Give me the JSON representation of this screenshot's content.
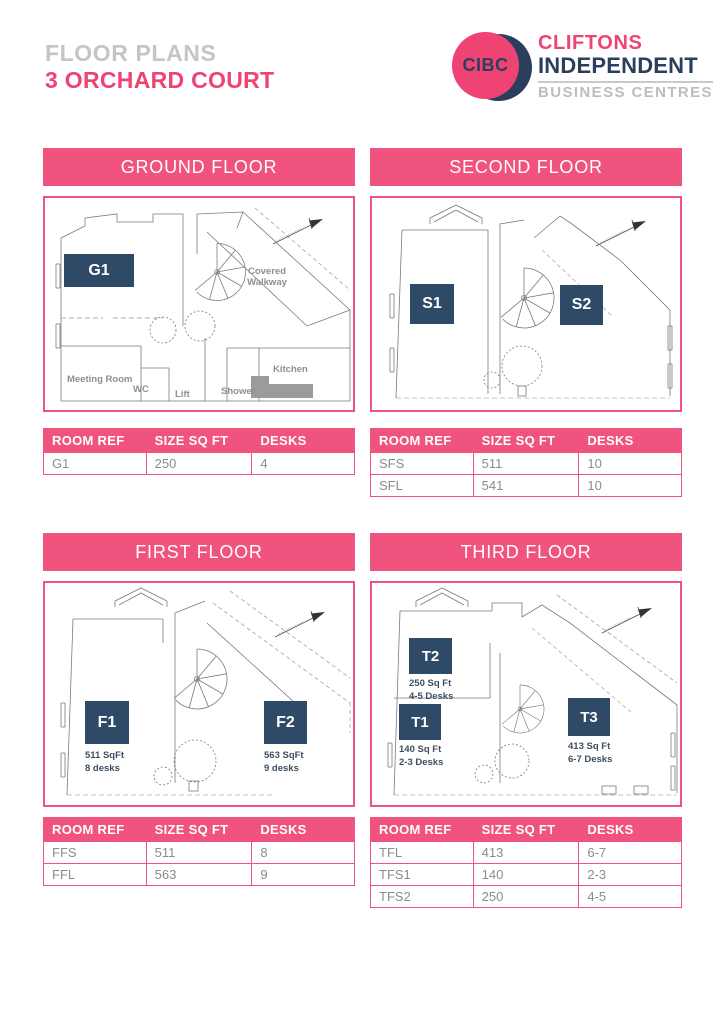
{
  "header": {
    "subtitle": "FLOOR PLANS",
    "title": "3 ORCHARD COURT"
  },
  "logo": {
    "badge_text": "CIBC",
    "name_top": "CLIFTONS",
    "name_bottom": "INDEPENDENT",
    "tagline": "BUSINESS CENTRES"
  },
  "colors": {
    "pink": "#F0537D",
    "title_pink": "#EE4373",
    "navy_room_box": "#2E4A66",
    "logo_navy": "#2B3F5C",
    "subtitle_gray": "#C5C5C5",
    "table_text_gray": "#8C8C8C",
    "plan_line_gray": "#7A7A7A"
  },
  "table_headers": [
    "ROOM REF",
    "SIZE SQ FT",
    "DESKS"
  ],
  "sections": {
    "ground": {
      "title": "GROUND FLOOR",
      "rooms": [
        {
          "id": "G1"
        }
      ],
      "labels": {
        "covered_walkway": "Covered Walkway",
        "meeting_room": "Meeting Room",
        "wc": "WC",
        "lift": "Lift",
        "shower": "Shower",
        "kitchen": "Kitchen"
      },
      "table": [
        [
          "G1",
          "250",
          "4"
        ]
      ]
    },
    "second": {
      "title": "SECOND FLOOR",
      "rooms": [
        {
          "id": "S1"
        },
        {
          "id": "S2"
        }
      ],
      "table": [
        [
          "SFS",
          "511",
          "10"
        ],
        [
          "SFL",
          "541",
          "10"
        ]
      ]
    },
    "first": {
      "title": "FIRST FLOOR",
      "rooms": [
        {
          "id": "F1",
          "size": "511 SqFt",
          "desks": "8 desks"
        },
        {
          "id": "F2",
          "size": "563 SqFt",
          "desks": "9 desks"
        }
      ],
      "table": [
        [
          "FFS",
          "511",
          "8"
        ],
        [
          "FFL",
          "563",
          "9"
        ]
      ]
    },
    "third": {
      "title": "THIRD FLOOR",
      "rooms": [
        {
          "id": "T1",
          "size": "140 Sq Ft",
          "desks": "2-3 Desks"
        },
        {
          "id": "T2",
          "size": "250 Sq Ft",
          "desks": "4-5 Desks"
        },
        {
          "id": "T3",
          "size": "413 Sq Ft",
          "desks": "6-7 Desks"
        }
      ],
      "table": [
        [
          "TFL",
          "413",
          "6-7"
        ],
        [
          "TFS1",
          "140",
          "2-3"
        ],
        [
          "TFS2",
          "250",
          "4-5"
        ]
      ]
    }
  }
}
